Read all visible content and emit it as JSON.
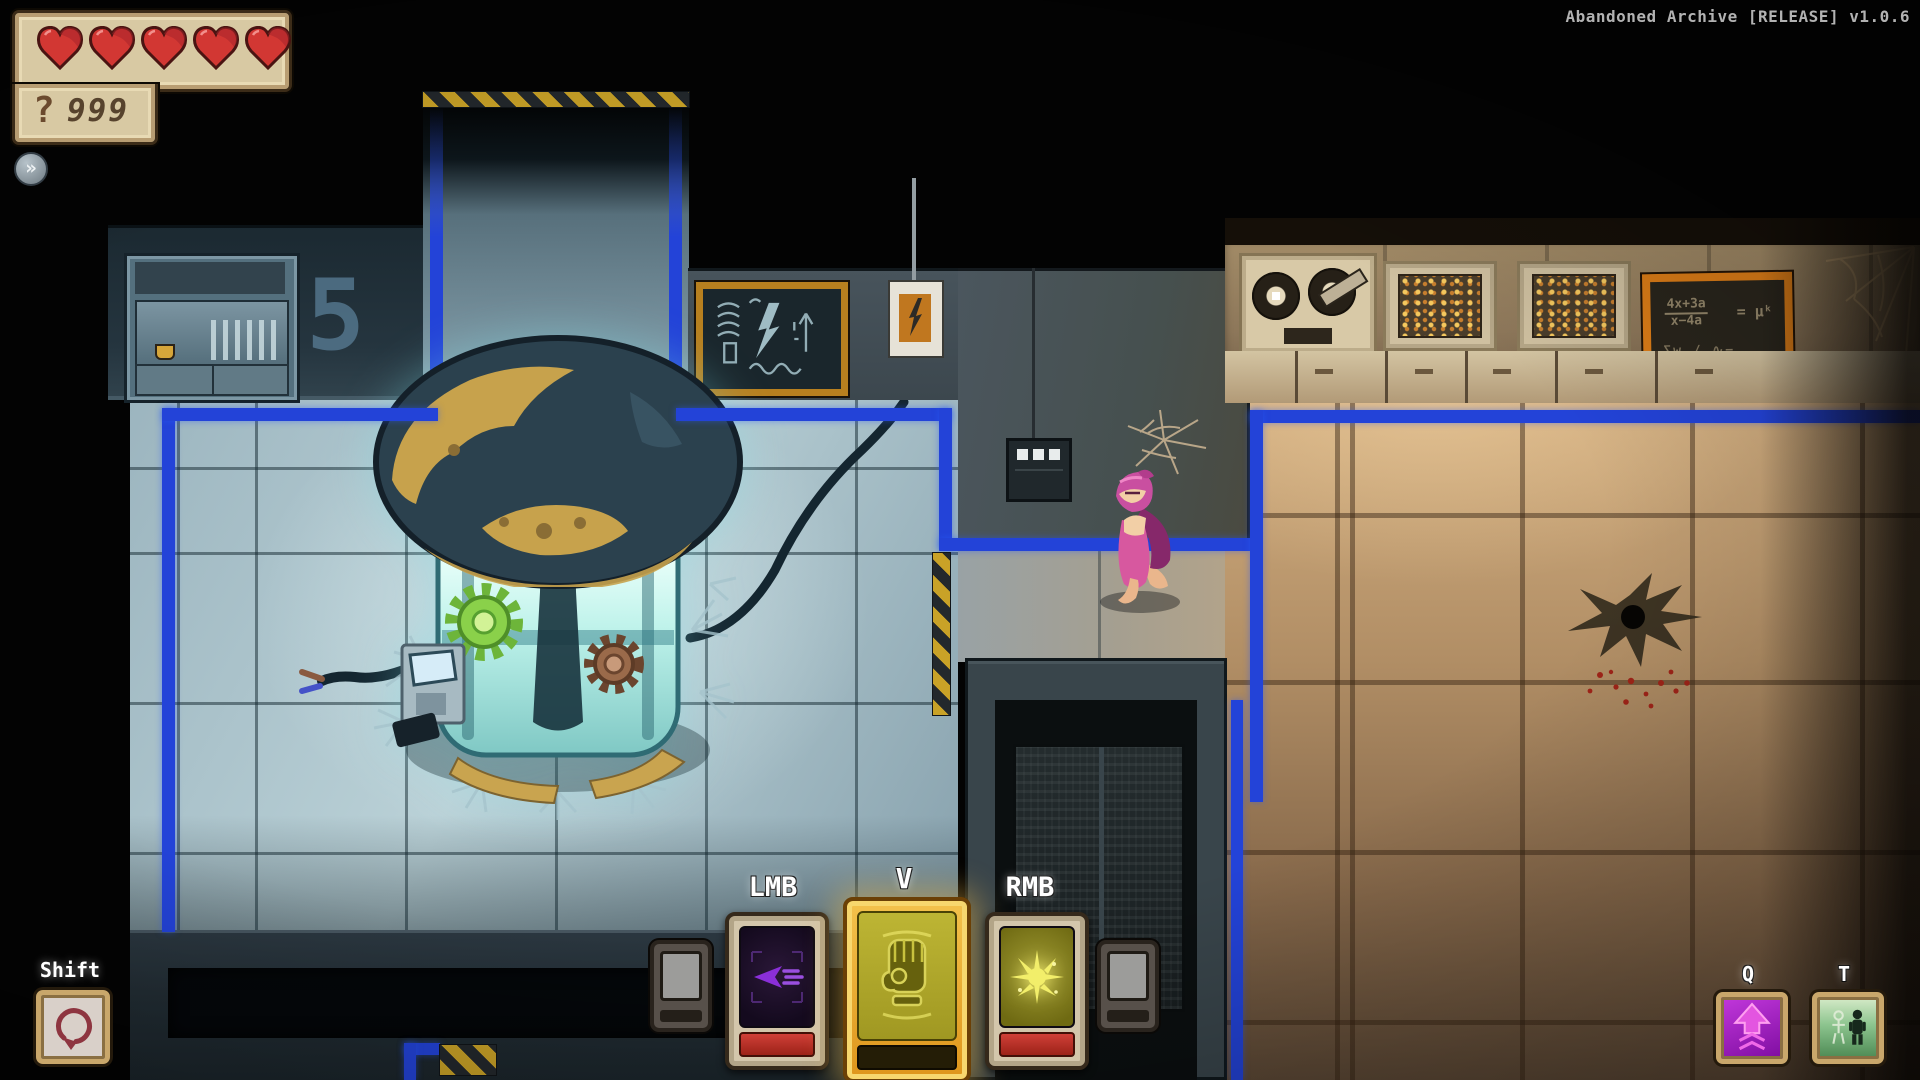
{
  "window": {
    "title": "Abandoned Archive [RELEASE] v1.0.6"
  },
  "hud": {
    "health": {
      "hearts": 5,
      "max_hearts": 5
    },
    "currency": {
      "symbol": "?",
      "value": "999"
    },
    "expand_button": "»",
    "abilities": {
      "dash": {
        "key": "Shift",
        "icon": "roll-arrow"
      },
      "primary": {
        "key": "LMB",
        "icon": "purple-dart"
      },
      "special": {
        "key": "V",
        "icon": "fist",
        "state": "active"
      },
      "secondary": {
        "key": "RMB",
        "icon": "energy-burst"
      },
      "upgrade": {
        "key": "Q",
        "icon": "up-arrow"
      },
      "swap": {
        "key": "T",
        "icon": "two-figures"
      }
    }
  },
  "world": {
    "wall_number": "5",
    "formula_board": {
      "numerator": "4x+3a",
      "denominator": "x−4a",
      "result": "= μᵏ",
      "line3": "∑w ∕ ∿−"
    }
  },
  "colors": {
    "hud_panel": "#d8c9a3",
    "heart": "#d23733",
    "blue_line": "#2343d8",
    "gold_frame": "#eaa21f",
    "hazard_yellow": "#c9a227",
    "lab_floor": "#a4bcc6",
    "archive_floor": "#bd9a6f"
  }
}
